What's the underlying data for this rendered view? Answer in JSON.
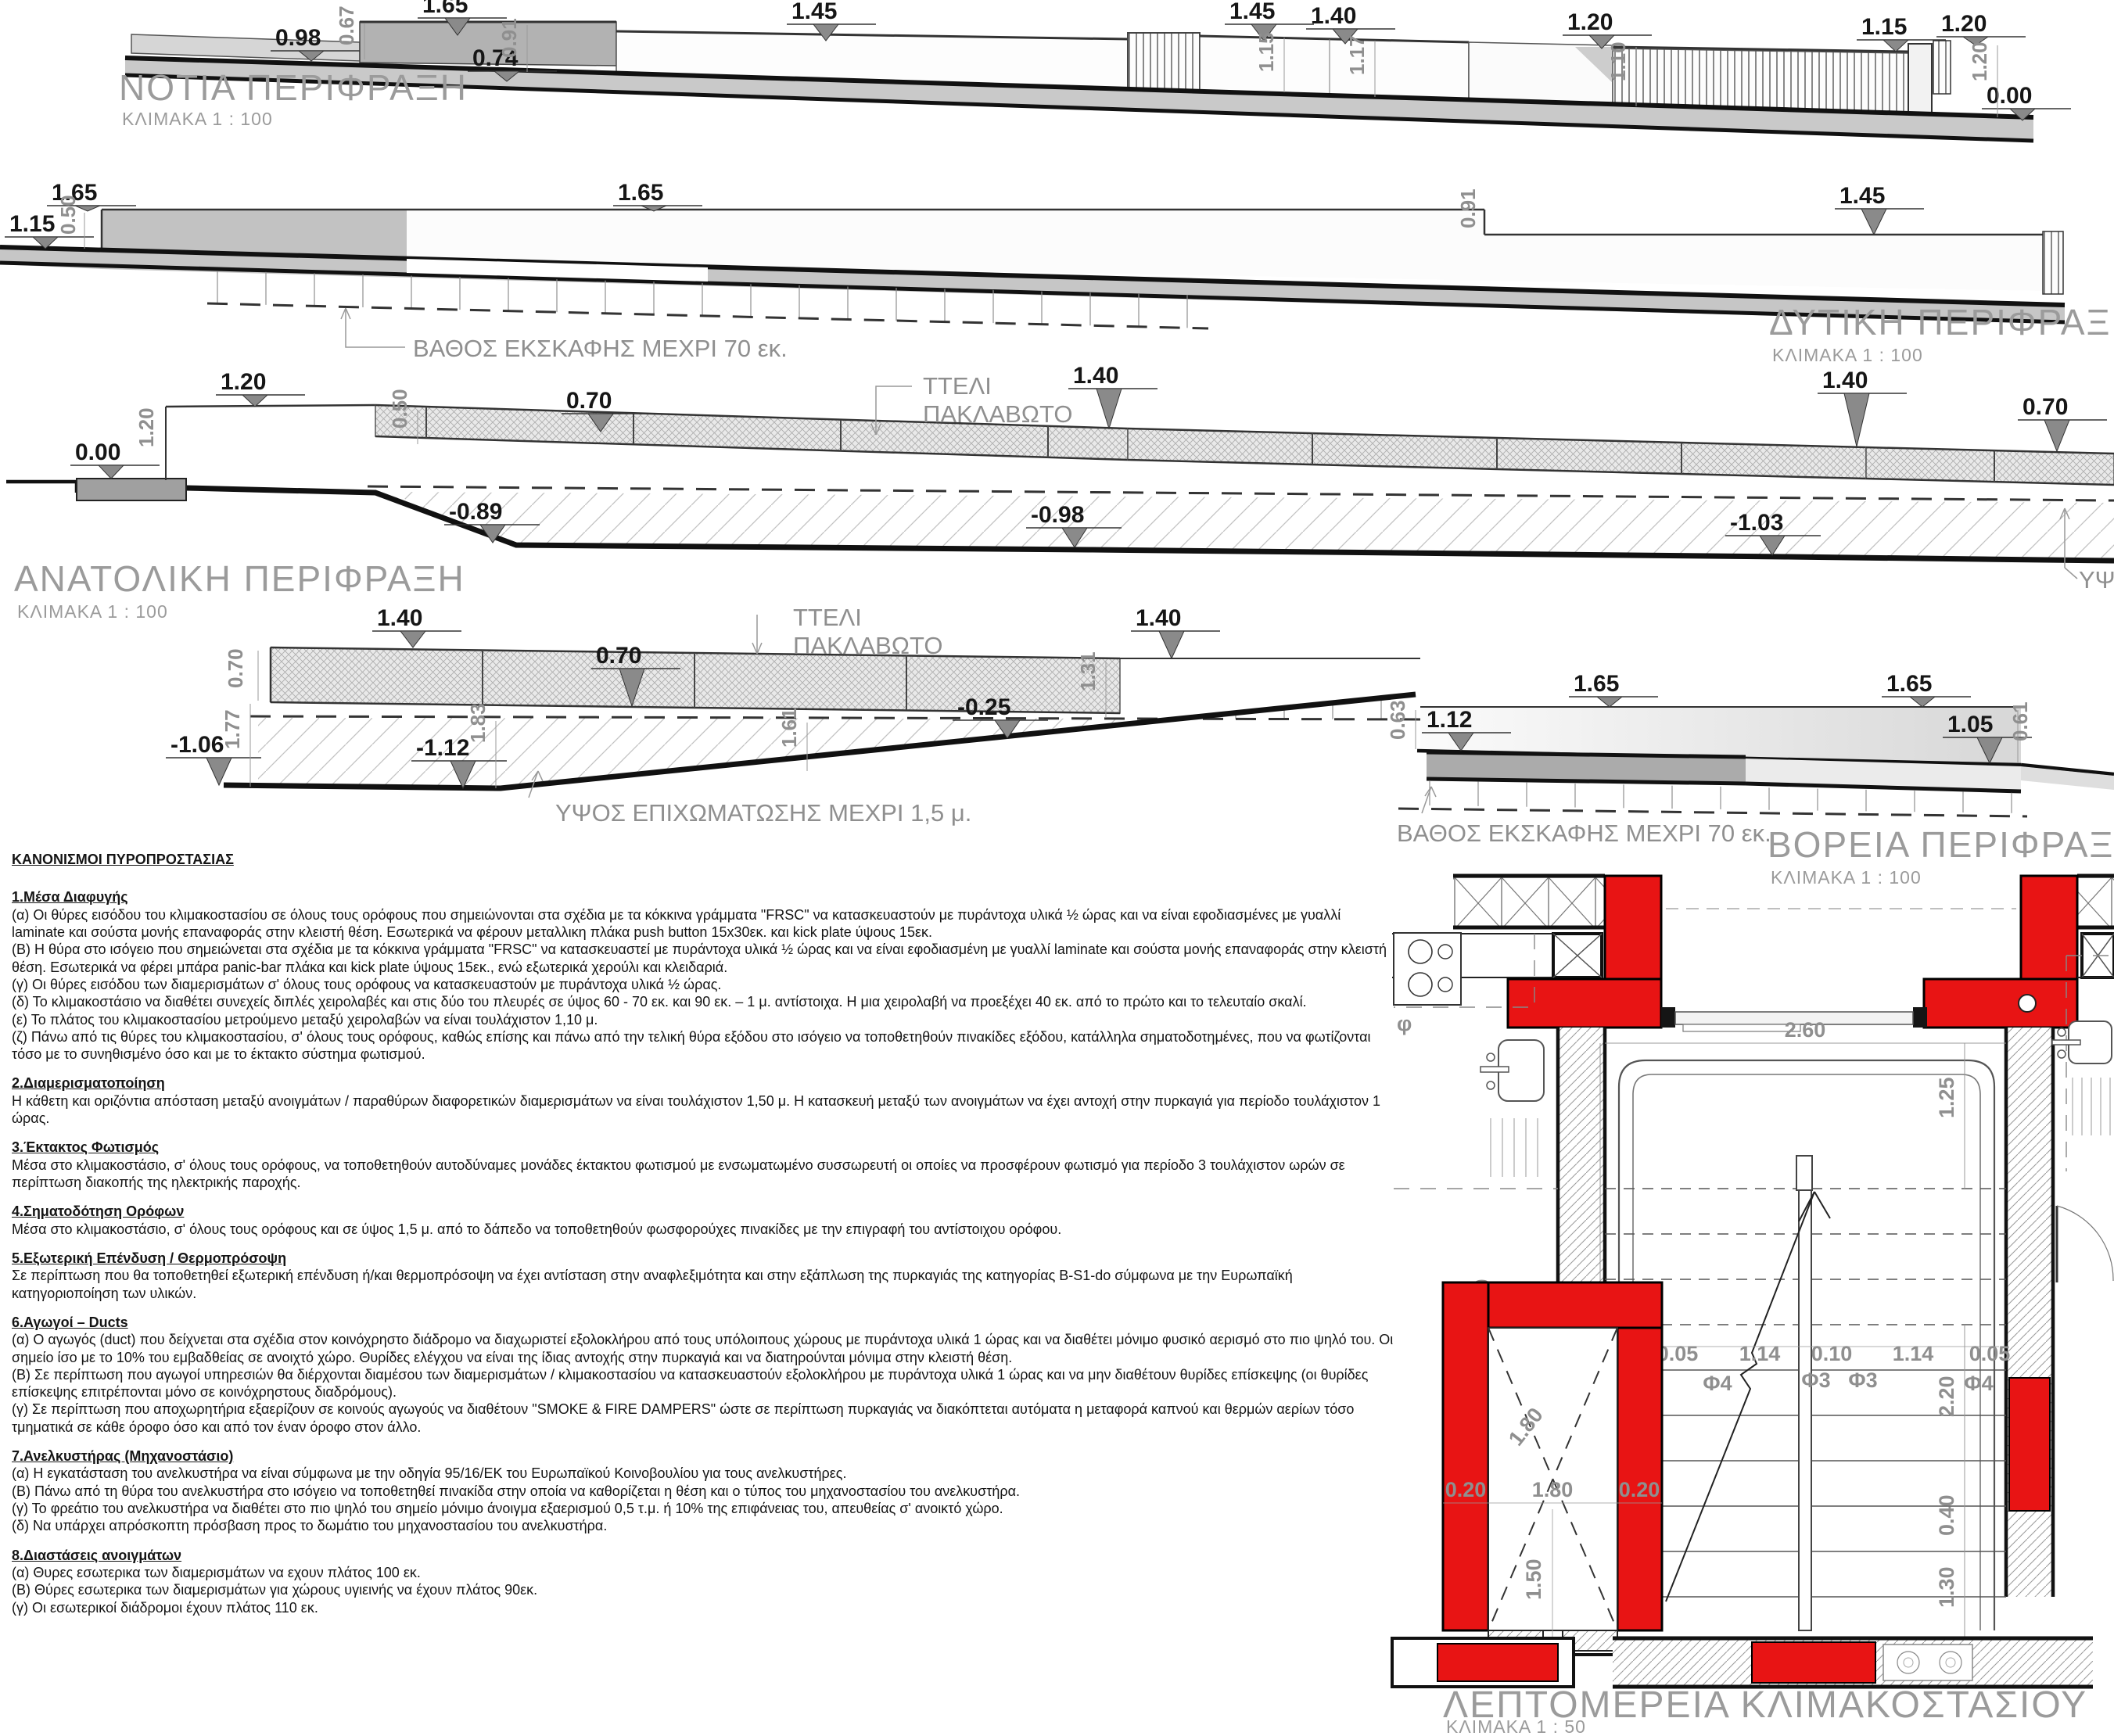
{
  "south": {
    "title": "ΝΟΤΙΑ ΠΕΡΙΦΡΑΞΗ",
    "scale": "ΚΛΙΜΑΚΑ 1 : 100",
    "levels": [
      "1.65",
      "1.45",
      "1.45",
      "1.40",
      "1.20",
      "1.15",
      "1.20",
      "0.98",
      "0.74",
      "0.00"
    ],
    "vdims": [
      "0.67",
      "0.91",
      "1.15",
      "1.17",
      "1.10",
      "1.20"
    ]
  },
  "west": {
    "title": "ΔΥΤΙΚΗ ΠΕΡΙΦΡΑΞΗ",
    "scale": "ΚΛΙΜΑΚΑ 1 : 100",
    "levels": [
      "1.15",
      "1.65",
      "1.65",
      "1.45"
    ],
    "vdims": [
      "0.50",
      "0.91"
    ],
    "note": "ΒΑΘΟΣ ΕΚΣΚΑΦΗΣ ΜΕΧΡΙ 70 εκ."
  },
  "east": {
    "title": "ΑΝΑΤΟΛΙΚΗ ΠΕΡΙΦΡΑΞΗ",
    "scale": "ΚΛΙΜΑΚΑ 1 : 100",
    "mesh_label": [
      "ΤΤΕΛΙ",
      "ΠΑΚΛΑΒΩΤΟ"
    ],
    "levels": [
      "0.00",
      "1.20",
      "0.70",
      "1.40",
      "1.40",
      "0.70",
      "-0.89",
      "-0.98",
      "-1.03"
    ],
    "vdims": [
      "1.20",
      "0.50"
    ],
    "clipped_note": "ΥΨΟ"
  },
  "north": {
    "title": "ΒΟΡΕΙΑ ΠΕΡΙΦΡΑΞΗ",
    "scale": "ΚΛΙΜΑΚΑ 1 : 100",
    "mesh_label": [
      "ΤΤΕΛΙ",
      "ΠΑΚΛΑΒΩΤΟ"
    ],
    "levels": [
      "1.40",
      "0.70",
      "1.40",
      "1.12",
      "1.65",
      "1.65",
      "1.05",
      "-1.06",
      "-1.12",
      "-0.25"
    ],
    "vdims": [
      "0.70",
      "1.77",
      "1.83",
      "1.61",
      "1.31",
      "0.63",
      "0.61"
    ],
    "note_depth": "ΒΑΘΟΣ ΕΚΣΚΑΦΗΣ ΜΕΧΡΙ 70 εκ.",
    "note_fill": "ΥΨΟΣ ΕΠΙΧΩΜΑΤΩΣΗΣ ΜΕΧΡΙ 1,5 μ."
  },
  "plan": {
    "title": "ΛΕΠΤΟΜΕΡΕΙΑ ΚΛΙΜΑΚΟΣΤΑΣΙΟΥ",
    "scale": "ΚΛΙΜΑΚΑ 1 : 50",
    "dims": {
      "width": "2.60",
      "landing": "1.25",
      "flight": "3.45",
      "wall": "0.20",
      "run": "2.20",
      "t1": "0.05",
      "t2": "1.14",
      "t3": "0.10",
      "t4": "1.14",
      "t5": "0.05",
      "f1": "Φ4",
      "f2": "Φ3",
      "f3": "Φ3",
      "f4": "Φ4",
      "lift1": "0.20",
      "lift2": "1.80",
      "lift3": "0.20",
      "cab": "1.80",
      "front": "1.50",
      "d040": "0.40",
      "d130": "1.30",
      "phi": "φ"
    }
  },
  "regulations": {
    "title": "ΚΑΝΟΝΙΣΜΟΙ  ΠΥΡΟΠΡΟΣΤΑΣΙΑΣ",
    "sections": [
      {
        "heading": "1.Μέσα Διαφυγής",
        "paras": [
          "(α) Οι θύρες εισόδου του κλιμακοστασίου σε όλους τους ορόφους που σημειώνονται στα σχέδια με τα κόκκινα γράμματα \"FRSC\" να κατασκευαστούν με πυράντοχα υλικά ½ ώρας και να είναι εφοδιασμένες με γυαλλί laminate και σούστα μονής επαναφοράς στην κλειστή θέση. Εσωτερικά να φέρουν μεταλλικη πλάκα push button 15x30εκ. και kick plate ύψους 15εκ.",
          "(Β) Η θύρα στο ισόγειο που σημειώνεται στα σχέδια με τα κόκκινα γράμματα \"FRSC\" να κατασκευαστεί με πυράντοχα υλικά ½ ώρας και να είναι εφοδιασμένη με γυαλλί laminate και σούστα μονής επαναφοράς στην κλειστή θέση. Εσωτερικά να φέρει μπάρα panic-bar πλάκα και kick plate ύψους 15εκ., ενώ εξωτερικά χερούλι και κλειδαριά.",
          "(γ) Οι θύρες εισόδου των διαμερισμάτων σ' όλους τους ορόφους να κατασκευαστούν με πυράντοχα υλικά ½ ώρας.",
          "(δ) Το κλιμακοστάσιο να διαθέτει συνεχείς διπλές χειρολαβές και στις δύο του πλευρές σε ύψος 60 - 70 εκ. και 90 εκ. – 1 μ. αντίστοιχα. Η μια χειρολαβή να προεξέχει 40 εκ. από το πρώτο και το τελευταίο σκαλί.",
          "(ε) Το πλάτος του κλιμακοστασίου μετρούμενο μεταξύ χειρολαβών να είναι τουλάχιστον 1,10 μ.",
          "(ζ) Πάνω από τις θύρες του κλιμακοστασίου, σ' όλους τους ορόφους, καθώς επίσης και πάνω από την τελική θύρα εξόδου στο ισόγειο να τοποθετηθούν πινακίδες εξόδου, κατάλληλα σηματοδοτημένες, που να φωτίζονται τόσο με το συνηθισμένο όσο και με το έκτακτο σύστημα φωτισμού."
        ]
      },
      {
        "heading": "2.Διαμερισματοποίηση",
        "paras": [
          "Η κάθετη και οριζόντια απόσταση μεταξύ ανοιγμάτων / παραθύρων διαφορετικών διαμερισμάτων να είναι τουλάχιστον 1,50 μ. Η κατασκευή μεταξύ των ανοιγμάτων να έχει αντοχή στην πυρκαγιά για περίοδο τουλάχιστον 1 ώρας."
        ]
      },
      {
        "heading": "3.Έκτακτος Φωτισμός",
        "paras": [
          "Μέσα στο κλιμακοστάσιο, σ' όλους τους ορόφους, να τοποθετηθούν αυτοδύναμες μονάδες έκτακτου φωτισμού με ενσωματωμένο συσσωρευτή οι οποίες να προσφέρουν φωτισμό για περίοδο 3 τουλάχιστον ωρών σε περίπτωση διακοπής της ηλεκτρικής παροχής."
        ]
      },
      {
        "heading": "4.Σηματοδότηση Ορόφων",
        "paras": [
          "Μέσα στο κλιμακοστάσιο, σ' όλους τους ορόφους και σε ύψος 1,5 μ. από το δάπεδο να τοποθετηθούν φωσφορούχες πινακίδες με την επιγραφή του αντίστοιχου ορόφου."
        ]
      },
      {
        "heading": "5.Εξωτερική Επένδυση / Θερμοπρόσοψη",
        "paras": [
          "Σε περίπτωση που θα τοποθετηθεί εξωτερική επένδυση ή/και θερμοπρόσοψη να έχει αντίσταση στην αναφλεξιμότητα και στην εξάπλωση της πυρκαγιάς της κατηγορίας B-S1-do σύμφωνα με την Ευρωπαϊκή κατηγοριοποίηση των υλικών."
        ]
      },
      {
        "heading": "6.Αγωγοί – Ducts",
        "paras": [
          "(α) Ο αγωγός (duct) που δείχνεται στα σχέδια στον κοινόχρηστο διάδρομο να διαχωριστεί εξολοκλήρου από τους υπόλοιπους χώρους με πυράντοχα υλικά 1 ώρας και να διαθέτει μόνιμο φυσικό αερισμό στο πιο ψηλό του. Οι σημείο ίσο με το 10% του εμβαδθείας σε ανοιχτό χώρο. Θυρίδες ελέγχου να είναι της ίδιας αντοχής στην πυρκαγιά και να διατηρούνται μόνιμα στην κλειστή θέση.",
          "(Β) Σε περίπτωση που αγωγοί υπηρεσιών θα διέρχονται διαμέσου των διαμερισμάτων / κλιμακοστασίου να κατασκευαστούν εξολοκλήρου με πυράντοχα υλικά 1 ώρας και να μην διαθέτουν θυρίδες επίσκεψης (οι θυρίδες επίσκεψης επιτρέπονται μόνο σε κοινόχρηστους διαδρόμους).",
          "(γ) Σε περίπτωση που αποχωρητήρια εξαερίζουν σε κοινούς αγωγούς να διαθέτουν \"SMOKE & FIRE DAMPERS\" ώστε σε περίπτωση πυρκαγιάς να διακόπτεται αυτόματα η μεταφορά καπνού και θερμών αερίων τόσο τμηματικά σε κάθε όροφο όσο και από τον έναν όροφο στον άλλο."
        ]
      },
      {
        "heading": "7.Ανελκυστήρας (Μηχανοστάσιο)",
        "paras": [
          "(α) Η εγκατάσταση του ανελκυστήρα να είναι σύμφωνα με την οδηγία 95/16/ΕΚ του Ευρωπαϊκού Κοινοβουλίου για τους ανελκυστήρες.",
          "(Β) Πάνω από τη θύρα του ανελκυστήρα στο ισόγειο να τοποθετηθεί πινακίδα στην οποία να καθορίζεται η θέση και ο τύπος του μηχανοστασίου του ανελκυστήρα.",
          "(γ) Το φρεάτιο του ανελκυστήρα να διαθέτει στο πιο ψηλό του σημείο μόνιμο άνοιγμα εξαερισμού 0,5 τ.μ. ή 10% της επιφάνειας του, απευθείας σ' ανοικτό χώρο.",
          "(δ) Να υπάρχει απρόσκοπτη πρόσβαση προς το δωμάτιο του μηχανοστασίου του ανελκυστήρα."
        ]
      },
      {
        "heading": "8.Διαστάσεις ανοιγμάτων",
        "paras": [
          "(α) Θυρες εσωτερικα των διαμερισμάτων να εχουν πλάτος 100 εκ.",
          "(Β) Θύρες εσωτερικα των διαμερισμάτων για χώρους υγιεινής να έχουν πλάτος 90εκ.",
          "(γ) Οι εσωτερικοί διάδρομοι έχουν πλάτος 110 εκ."
        ]
      }
    ]
  }
}
